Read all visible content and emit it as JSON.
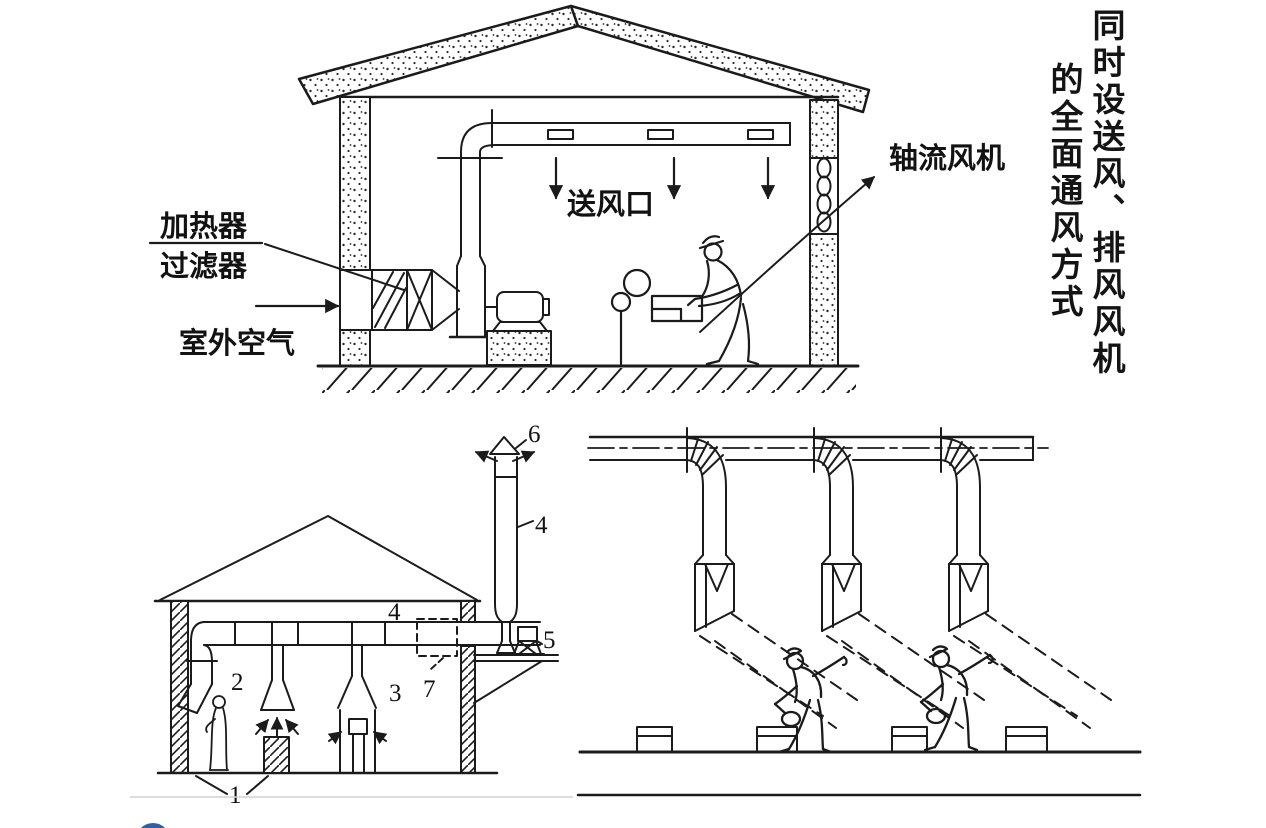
{
  "colors": {
    "ink": "#1b1b1b",
    "logo_blue": "#2f5fa7",
    "divider_gray": "#d2d2d2"
  },
  "title": {
    "full": "同时设送风、排风风机的全面通风方式",
    "column_right": "同时设送风、排风风机",
    "column_left": "的全面通风方式"
  },
  "top_diagram": {
    "labels": {
      "heater": "加热器",
      "filter": "过滤器",
      "outdoor_air": "室外空气",
      "supply_outlet": "送风口",
      "axial_fan": "轴流风机"
    }
  },
  "bottom_left_diagram": {
    "callouts": {
      "c1": "1",
      "c2": "2",
      "c3": "3",
      "c4": "4",
      "c5": "5",
      "c6": "6",
      "c7": "7"
    }
  }
}
